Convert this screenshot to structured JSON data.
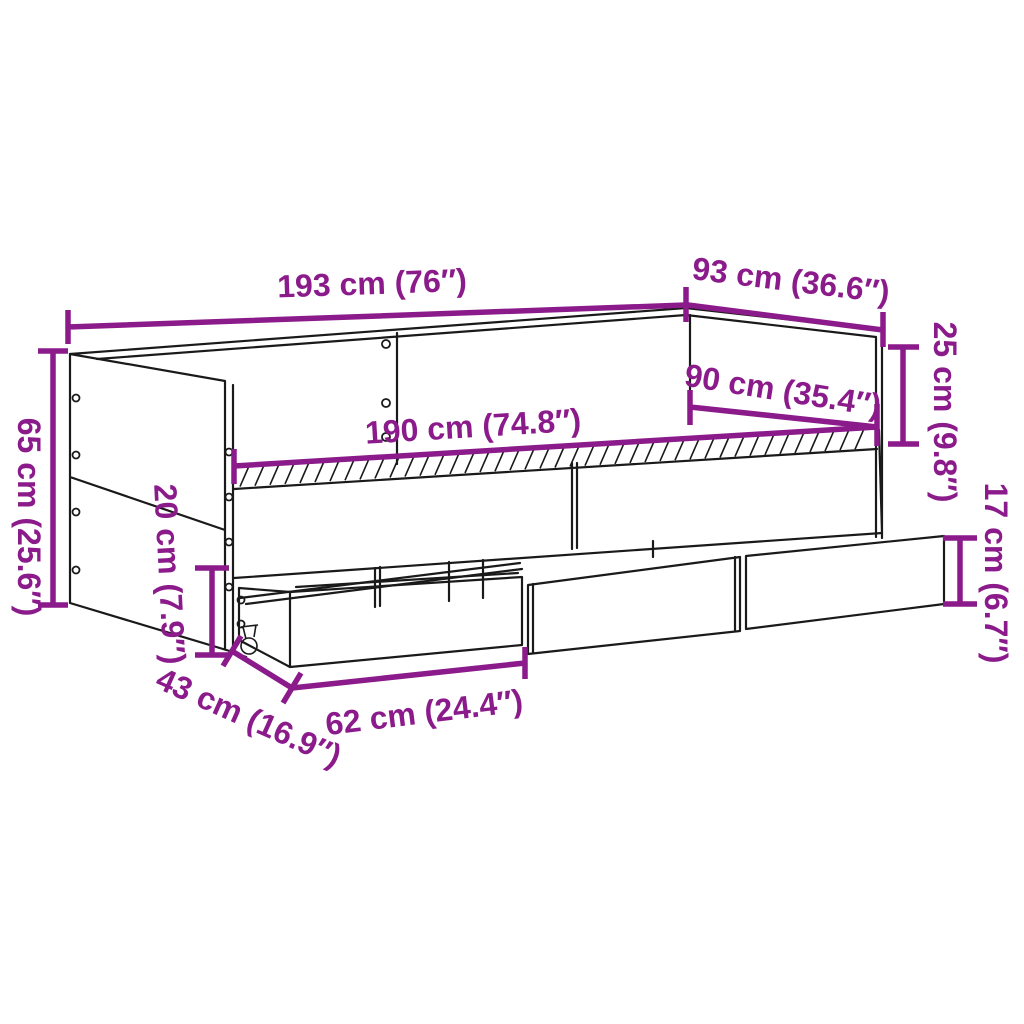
{
  "colors": {
    "dimension_accent": "#8B1A8B",
    "drawing_line": "#1A1A1A",
    "background": "#FFFFFF"
  },
  "diagram": {
    "subject": "daybed-with-drawers-dimension-diagram",
    "dimensions": [
      {
        "id": "total-length",
        "label": "193 cm (76″)"
      },
      {
        "id": "total-depth",
        "label": "93 cm (36.6″)"
      },
      {
        "id": "backrest-height",
        "label": "25 cm (9.8″)"
      },
      {
        "id": "mattress-width",
        "label": "90 cm (35.4″)"
      },
      {
        "id": "mattress-length",
        "label": "190 cm (74.8″)"
      },
      {
        "id": "side-panel-height",
        "label": "65 cm (25.6″)"
      },
      {
        "id": "underbed-clearance",
        "label": "20 cm (7.9″)"
      },
      {
        "id": "drawer-height",
        "label": "17 cm (6.7″)"
      },
      {
        "id": "drawer-pullout",
        "label": "43 cm (16.9″)"
      },
      {
        "id": "drawer-width",
        "label": "62 cm (24.4″)"
      }
    ]
  }
}
